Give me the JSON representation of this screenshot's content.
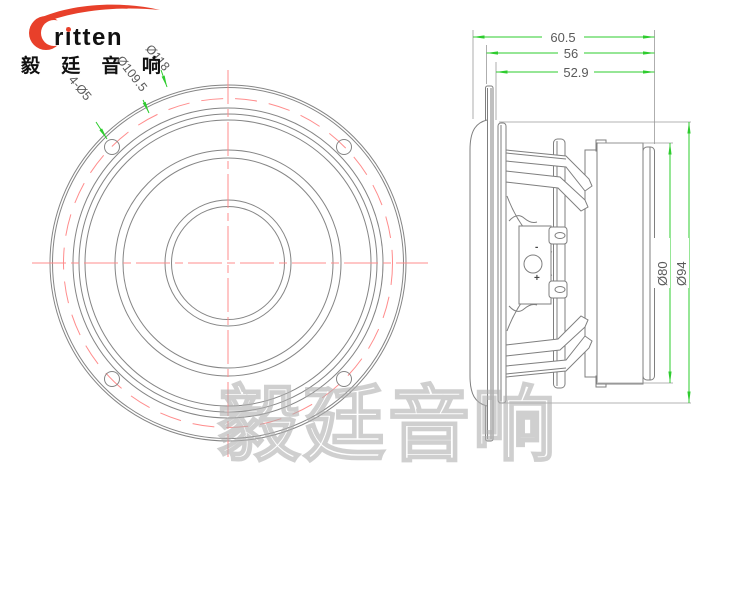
{
  "logo": {
    "brand": "ritten",
    "tagline": "毅 廷 音 响"
  },
  "watermark": "毅廷音响",
  "front_view": {
    "labels": {
      "mounting_holes": "4-Ø5",
      "bolt_circle_diameter": "Ø109.5",
      "outer_diameter": "Ø118"
    }
  },
  "side_view": {
    "dims": {
      "total_depth": "60.5",
      "frame_depth": "56",
      "basket_depth": "52.9",
      "magnet_diameter": "Ø80",
      "rear_ring_diameter": "Ø94"
    },
    "terminal": {
      "minus": "-",
      "plus": "+"
    }
  },
  "colors": {
    "line": "#7f7f7f",
    "dimension_green": "#2ecc2e",
    "centerline_red": "#ff8c8c",
    "brand_red": "#e8402a",
    "text_dark": "#1a1a1a",
    "watermark_gray": "#afafaf"
  }
}
